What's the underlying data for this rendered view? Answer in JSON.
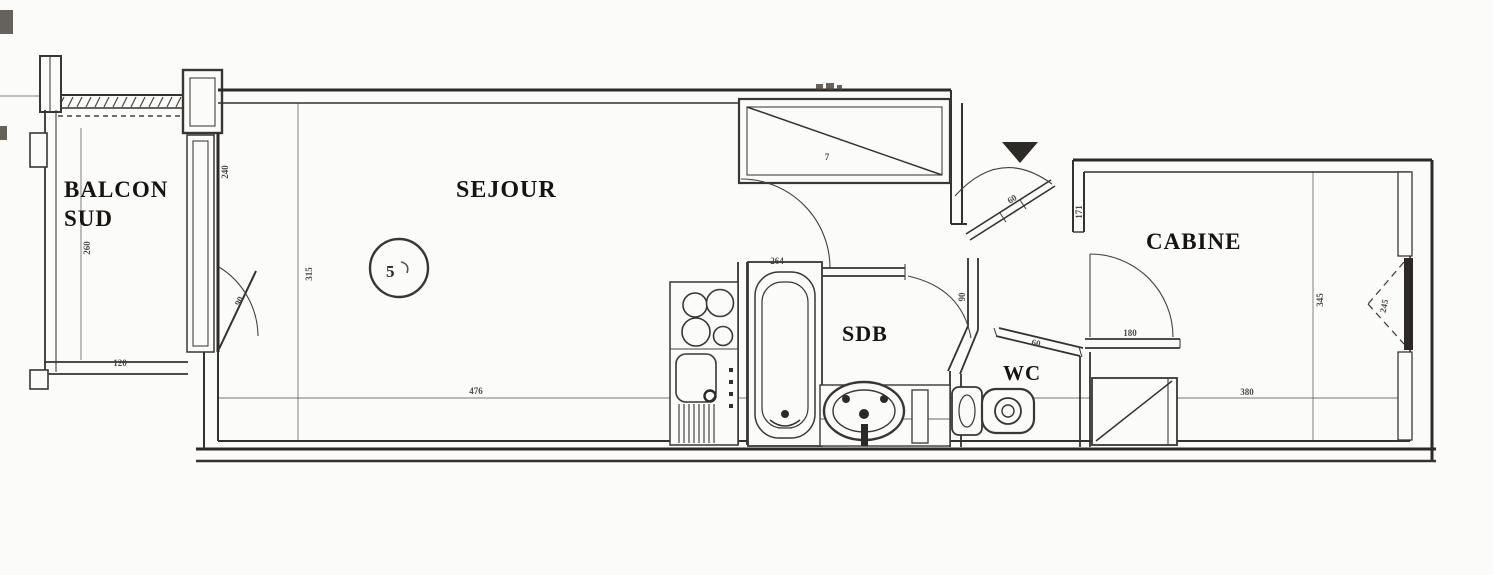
{
  "title": "Apartment floor plan scan",
  "colors": {
    "paper": "#fbfbf9",
    "ink": "#35322e",
    "dim_ink": "#3f3c37"
  },
  "rooms": {
    "balcon": {
      "line1": "BALCON",
      "line2": "SUD"
    },
    "sejour": {
      "label": "SEJOUR"
    },
    "sdb": {
      "label": "SDB"
    },
    "wc": {
      "label": "WC"
    },
    "cabine": {
      "label": "CABINE"
    }
  },
  "symbols": {
    "closet_mark": "7",
    "table_mark": "5"
  },
  "dimensions": {
    "balcony_height": "260",
    "balcony_width": "120",
    "window_width": "240",
    "balcony_door": "90",
    "sejour_depth": "315",
    "sejour_width": "476",
    "sdb_wall": "264",
    "sdb_door": "90",
    "entry_door": "60",
    "wc_door": "60",
    "cabine_jamb": "171",
    "cabine_door": "180",
    "cabine_width": "380",
    "cabine_depth": "345",
    "cabine_window": "245"
  }
}
